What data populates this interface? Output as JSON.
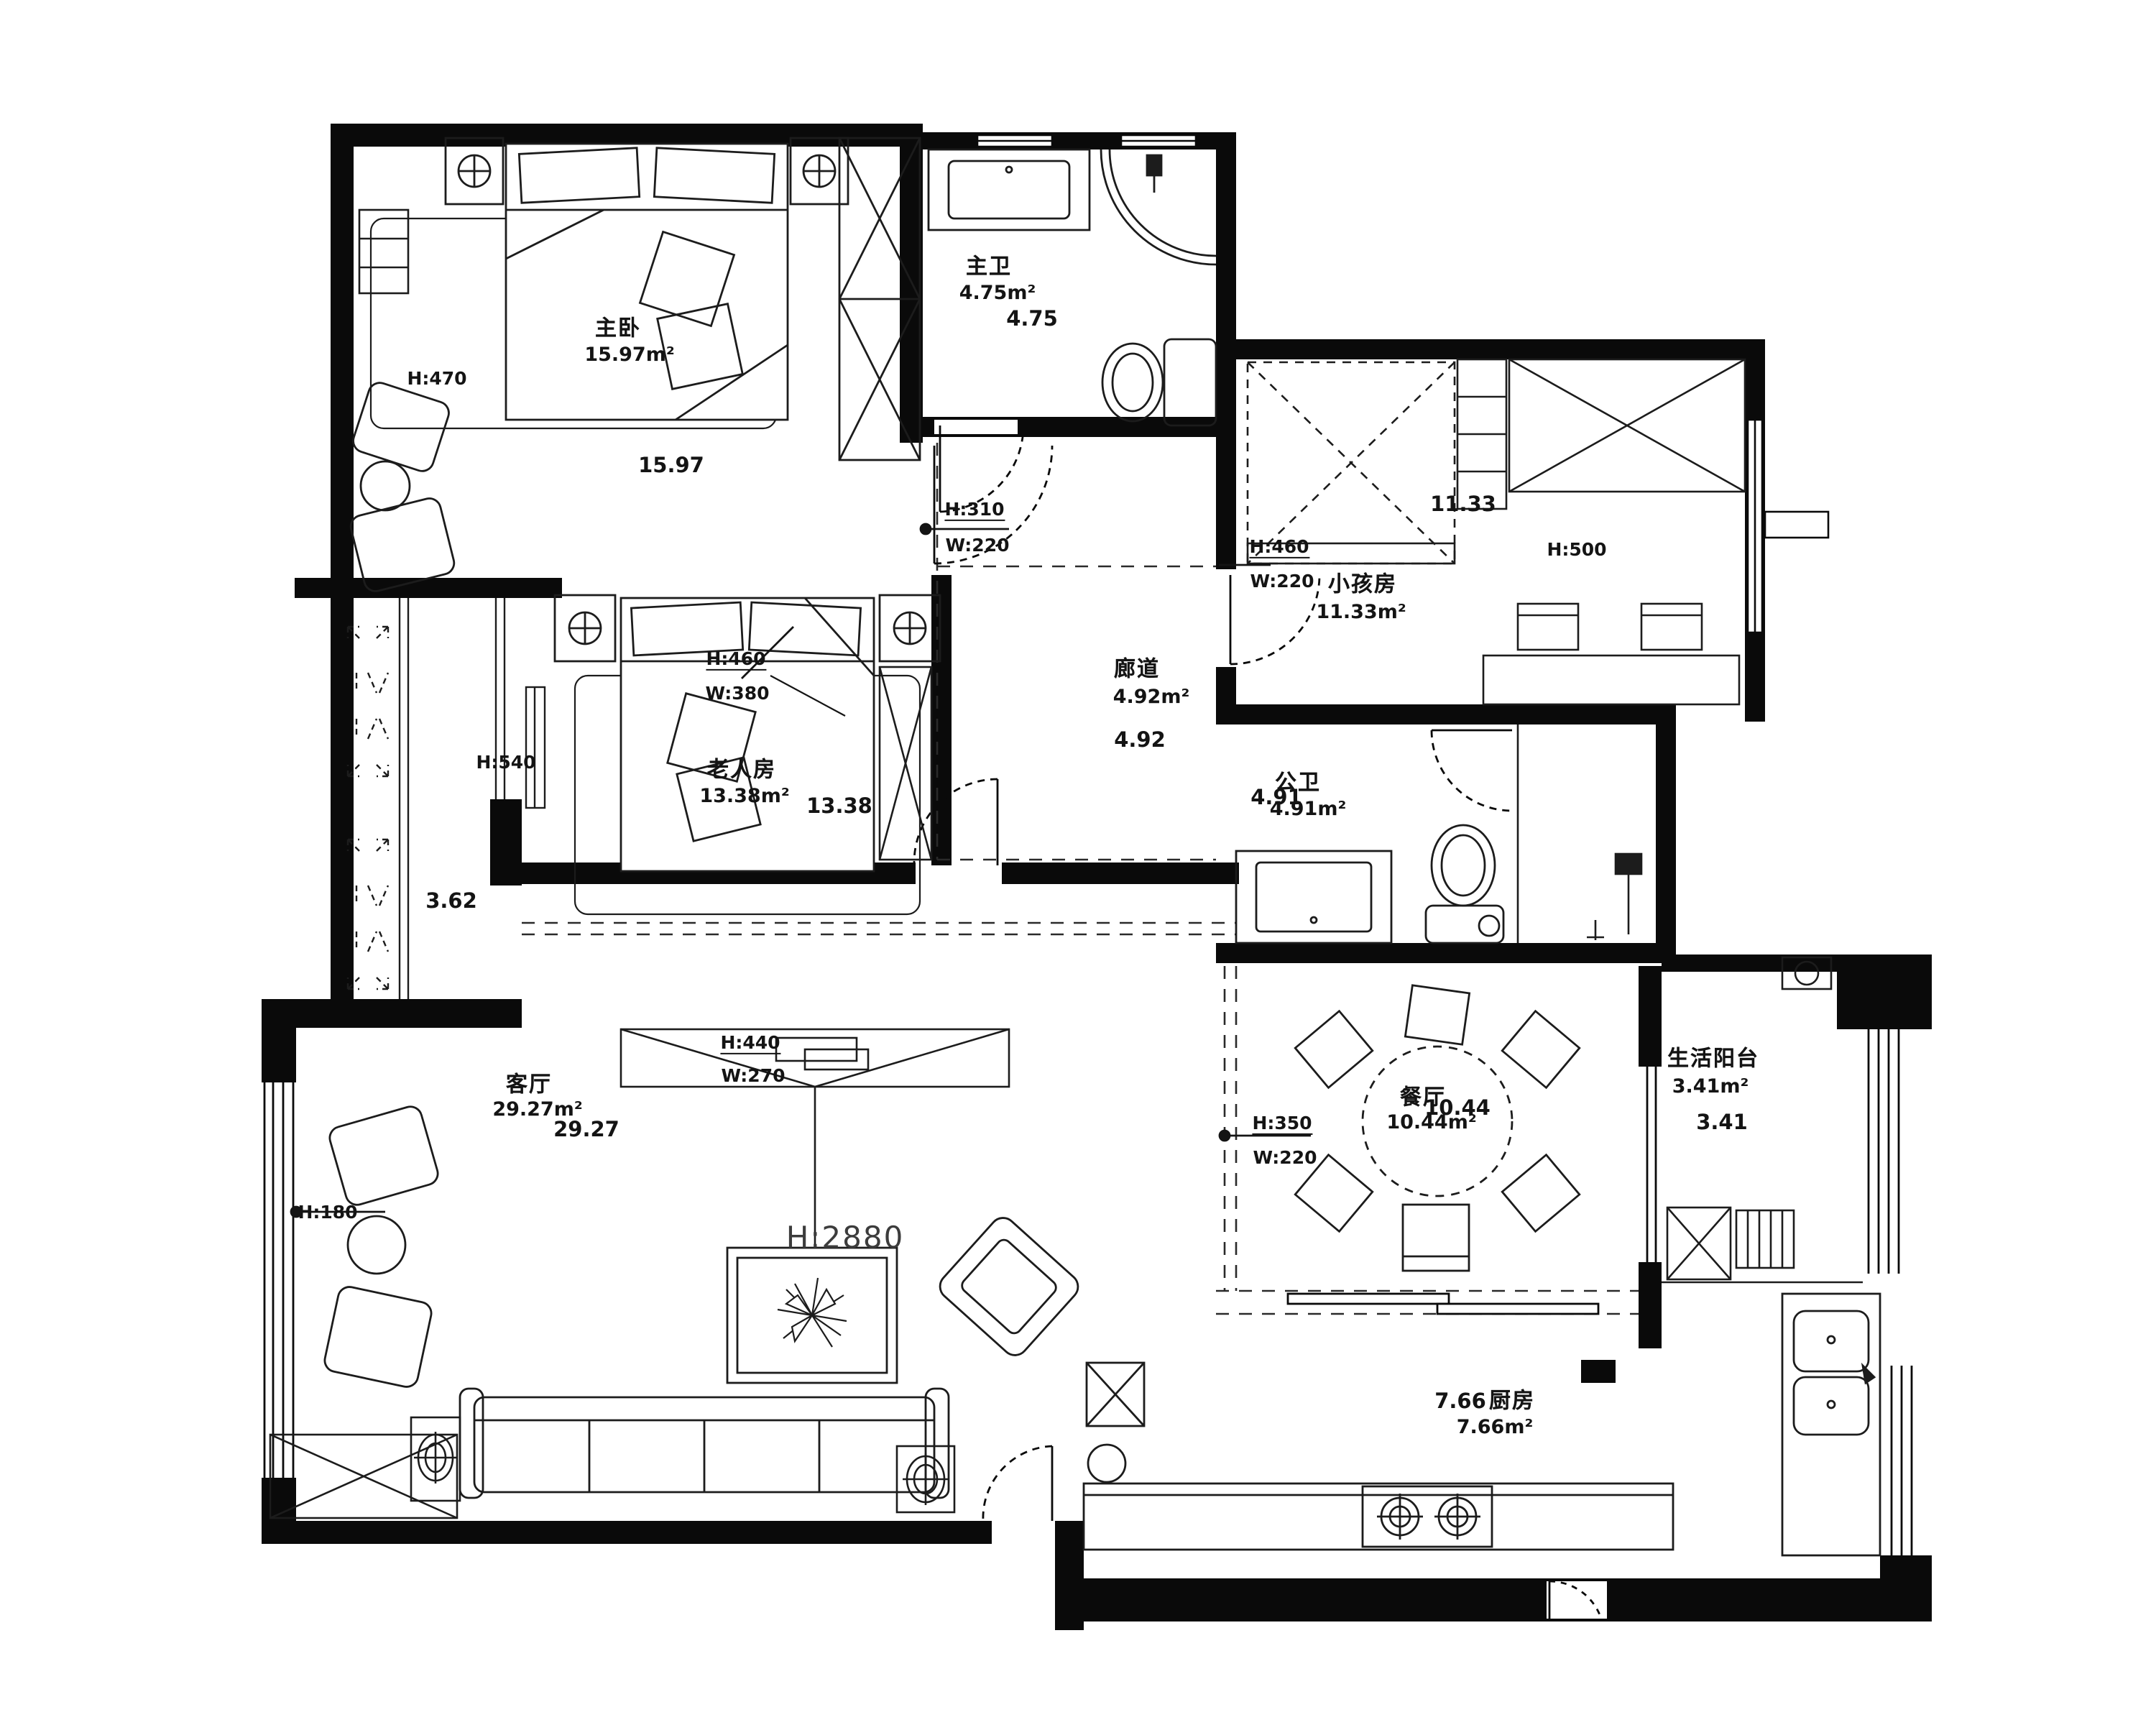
{
  "plan": {
    "rooms": {
      "master_bedroom": {
        "name": "主卧",
        "area": "15.97m²",
        "dim": "15.97",
        "h_label": "H:470"
      },
      "master_bath": {
        "name": "主卫",
        "area": "4.75m²",
        "dim": "4.75"
      },
      "kids_room": {
        "name": "小孩房",
        "area": "11.33m²",
        "dim": "11.33",
        "h_label": "H:500",
        "door": {
          "h": "H:460",
          "w": "W:220"
        }
      },
      "elder_room": {
        "name": "老人房",
        "area": "13.38m²",
        "dim": "13.38",
        "h_label": "H:540",
        "window": {
          "h": "H:460",
          "w": "W:380"
        }
      },
      "corridor": {
        "name": "廊道",
        "area": "4.92m²",
        "dim": "4.92",
        "door": {
          "h": "H:310",
          "w": "W:220"
        }
      },
      "public_bath": {
        "name": "公卫",
        "area": "4.91m²",
        "dim": "4.91"
      },
      "living_room": {
        "name": "客厅",
        "area": "29.27m²",
        "dim": "29.27",
        "ceiling": "H:2880",
        "h_label": "H:180",
        "tv": {
          "h": "H:440",
          "w": "W:270"
        }
      },
      "dining_room": {
        "name": "餐厅",
        "area": "10.44m²",
        "dim": "10.44",
        "door": {
          "h": "H:350",
          "w": "W:220"
        }
      },
      "balcony": {
        "name": "生活阳台",
        "area": "3.41m²",
        "dim": "3.41"
      },
      "kitchen": {
        "name": "厨房",
        "area": "7.66m²",
        "dim": "7.66"
      },
      "shaft": {
        "dim": "3.62"
      }
    }
  }
}
